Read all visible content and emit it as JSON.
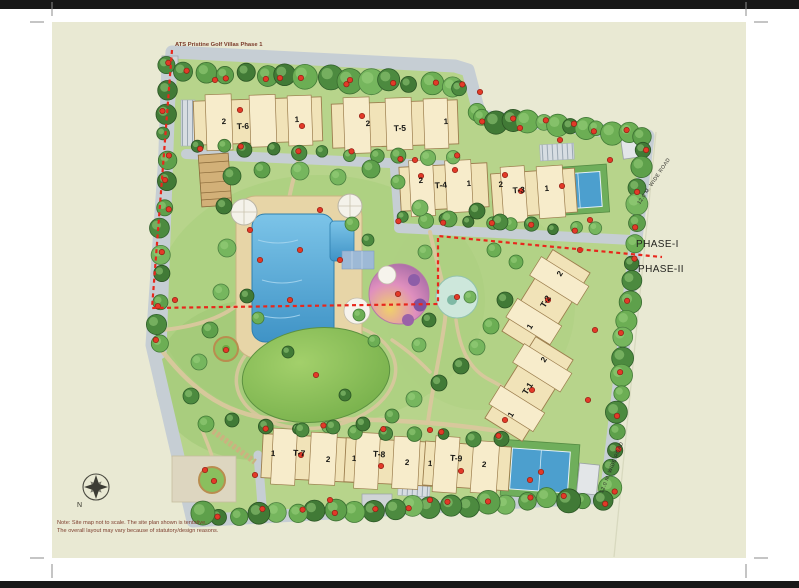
{
  "sheet": {
    "top_label": "ATS Pristine Golf Villas Phase 1",
    "phase1_label": "PHASE-I",
    "phase2_label": "PHASE-II",
    "road_labels": [
      "12.0 M. WIDE ROAD",
      "12.0 M. WIDE ROAD"
    ],
    "compass_north_label": "N",
    "note_line1": "Note: Site map not to scale. The site plan shown is tentative.",
    "note_line2": "The overall layout may vary because of statutory/design reasons."
  },
  "towers": [
    {
      "name": "T-6",
      "wings": [
        "2",
        "1"
      ]
    },
    {
      "name": "T-5",
      "wings": [
        "2",
        "1"
      ]
    },
    {
      "name": "T-4",
      "wings": [
        "2",
        "1"
      ]
    },
    {
      "name": "T-3",
      "wings": [
        "2",
        "1"
      ]
    },
    {
      "name": "T-2",
      "wings": [
        "2",
        "1"
      ]
    },
    {
      "name": "T-1",
      "wings": [
        "2",
        "1"
      ]
    },
    {
      "name": "T-7",
      "wings": [
        "1",
        "2"
      ]
    },
    {
      "name": "T-8",
      "wings": [
        "1",
        "2"
      ]
    },
    {
      "name": "T-9",
      "wings": [
        "1",
        "2"
      ]
    }
  ]
}
